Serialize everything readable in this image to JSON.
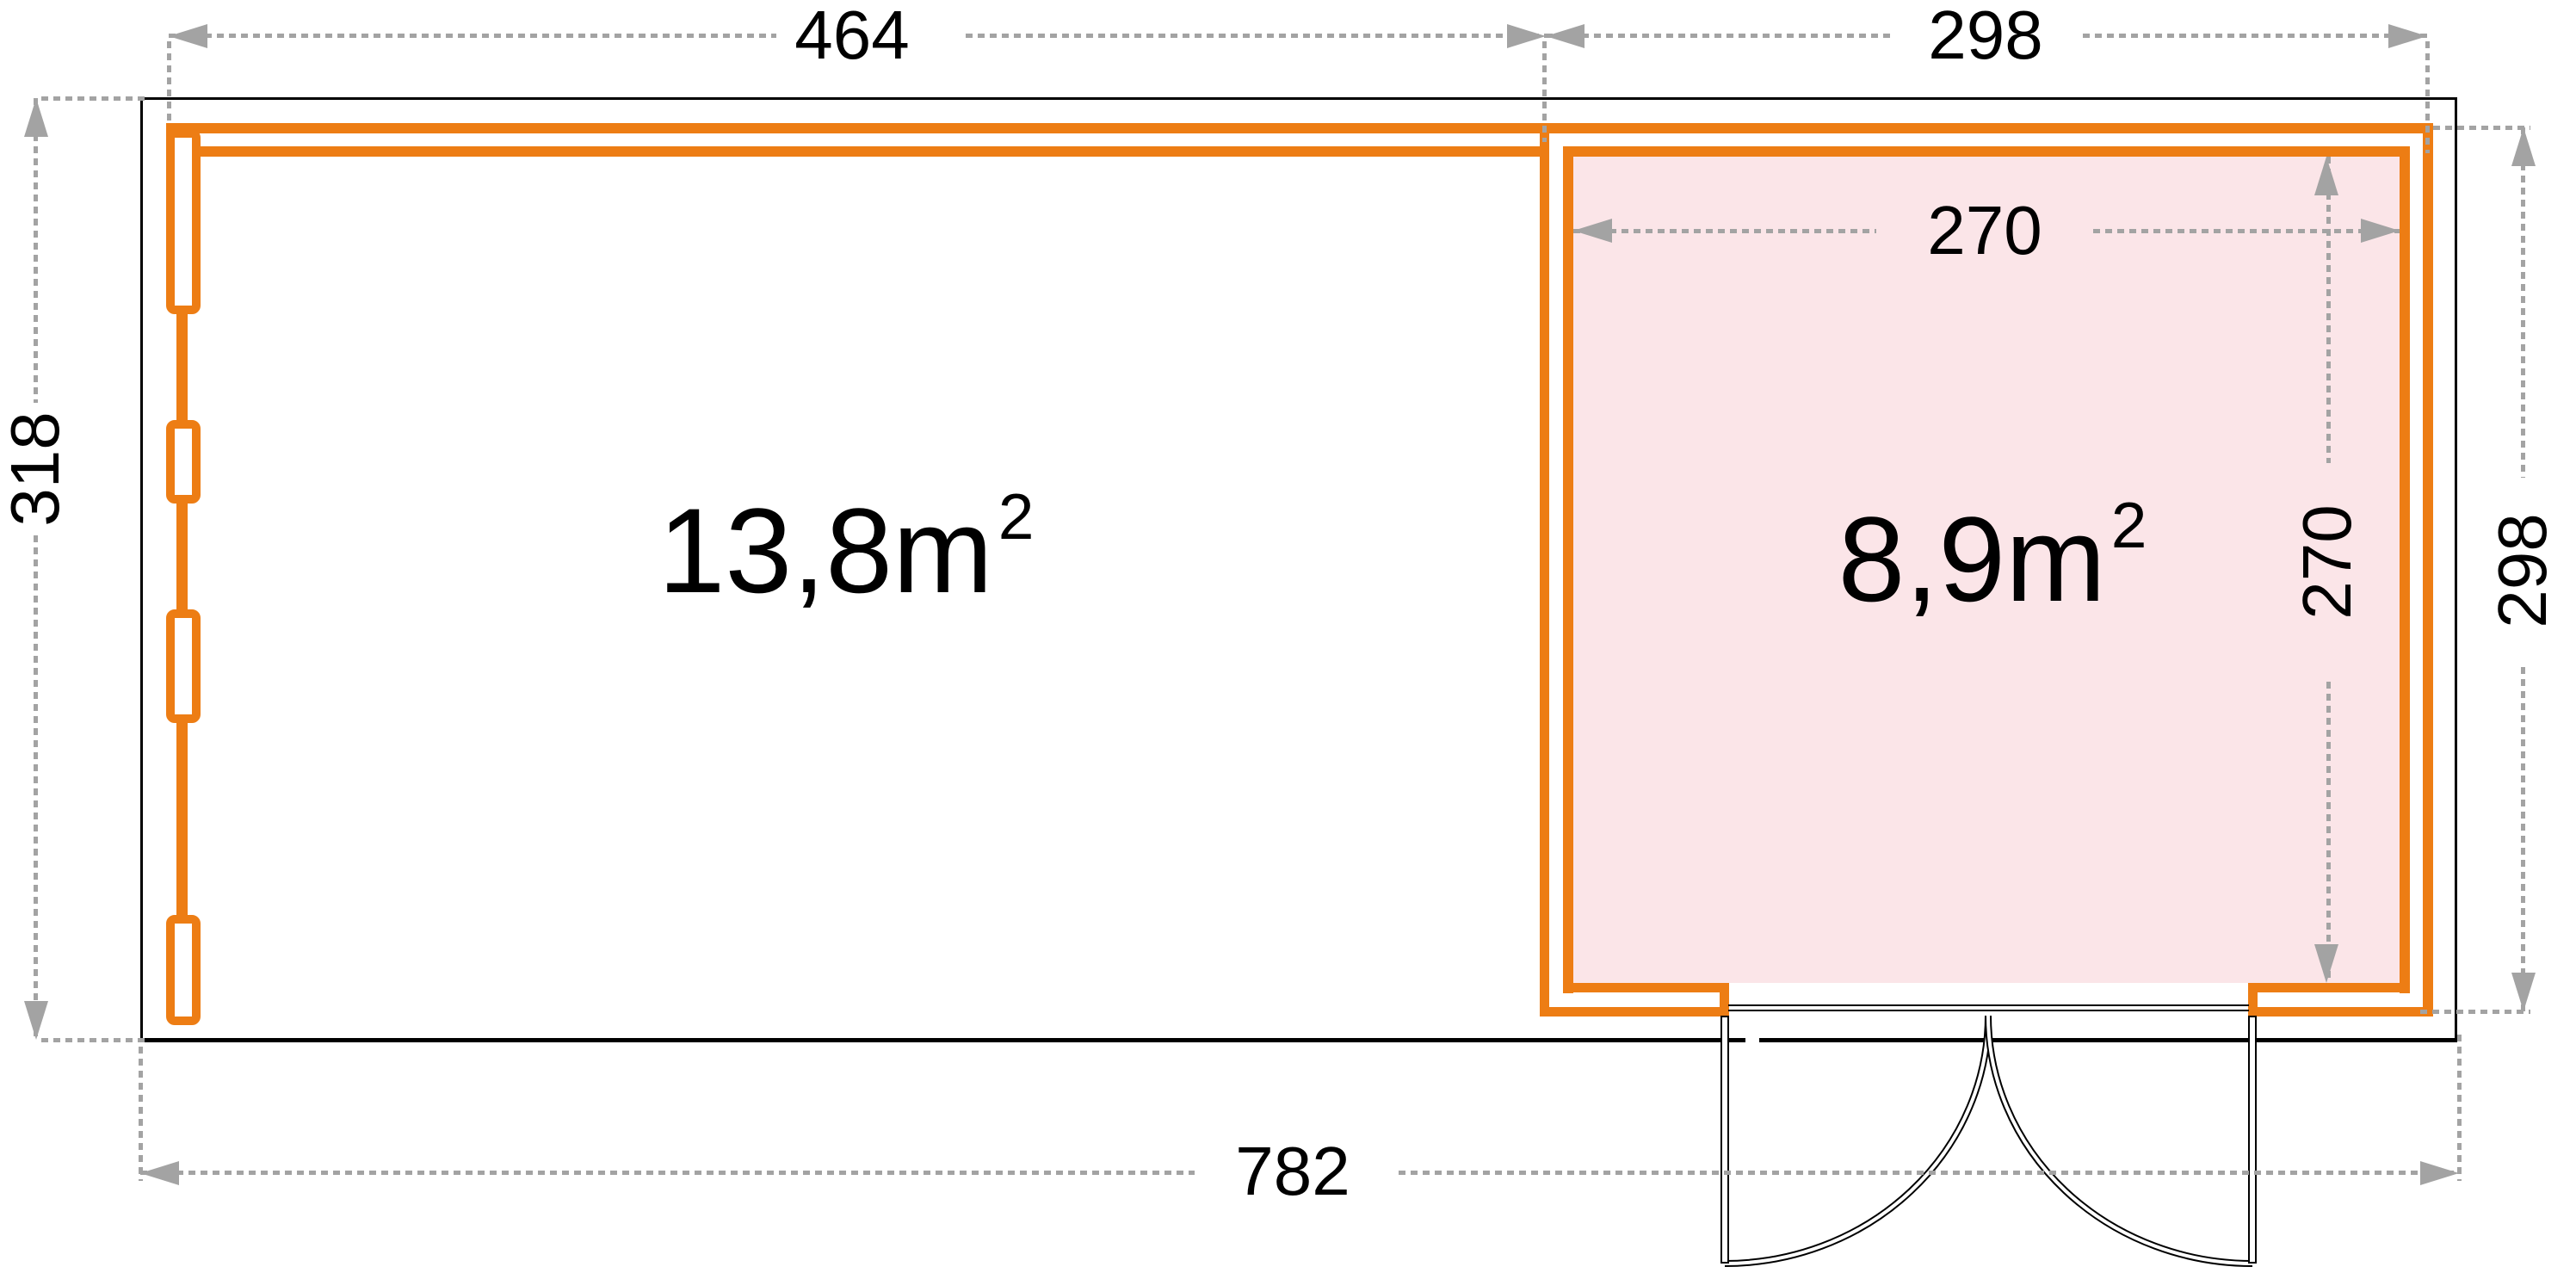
{
  "page": {
    "title": "Garden house floor plan"
  },
  "colors": {
    "orange": "#ED7D14",
    "pink": "#FBE5E8",
    "gray": "#A3A3A3",
    "black": "#000000"
  },
  "dimensions": {
    "top_left_width": "464",
    "top_right_width": "298",
    "left_height": "318",
    "bottom_total_width": "782",
    "right_height": "298",
    "inner_room_width": "270",
    "inner_room_height": "270"
  },
  "rooms": {
    "left_area": {
      "value": "13,8m",
      "exponent": "2"
    },
    "right_area": {
      "value": "8,9m",
      "exponent": "2"
    }
  }
}
